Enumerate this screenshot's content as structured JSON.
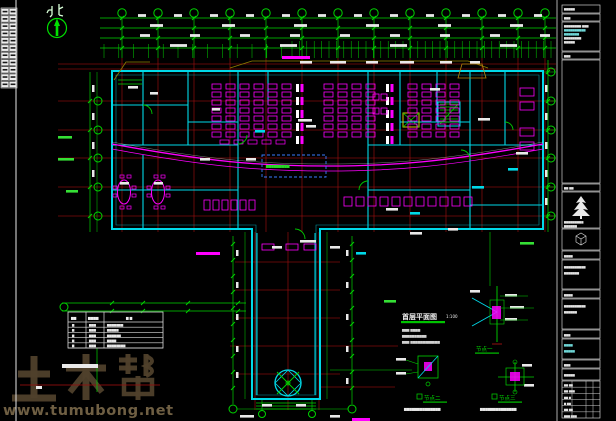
{
  "colors": {
    "green": "#00d400",
    "brightgreen": "#35e035",
    "cyan": "#00d9e8",
    "magenta": "#ff00ff",
    "red": "#8f0f0f",
    "yellow": "#d8c300",
    "olive": "#8f7f00",
    "white": "#e9e9e9",
    "blue": "#3a7bff",
    "watermark_brand": "#4f402b",
    "watermark_url": "#6f5f43"
  },
  "compass": {
    "label": "北"
  },
  "watermark": {
    "brand": "土木帮",
    "url": "www.tumubong.net"
  },
  "plan": {
    "title": "首层平面图",
    "scale": "1:100",
    "notes": [
      "▆▆▆ ▆▆▆▆",
      "▆▆▆▆▆▆▆▆▆▆",
      "▆▆▆ ▆▆▆▆▆▆▆▆▆▆▆▆"
    ],
    "center_note": "▆▆▆▆▆▆▆▆▆"
  },
  "details": {
    "d1": "节点一",
    "d2": "节点二",
    "d3": "节点三",
    "caption2": "▆▆▆▆▆▆▆▆▆▆▆▆▆▆",
    "caption3": "▆▆▆▆▆▆▆▆▆▆▆▆▆▆"
  },
  "legend": {
    "headers": [
      "▆▆",
      "▆▆▆▆",
      "▆ ▆"
    ],
    "rows": [
      [
        "▆",
        "▆▆▆",
        "▆▆▆▆▆▆▆"
      ],
      [
        "▆",
        "▆▆▆",
        "▆▆▆▆▆"
      ],
      [
        "▆",
        "▆▆▆",
        "▆▆▆▆▆▆"
      ],
      [
        "▆",
        "▆▆▆",
        "▆▆▆▆"
      ],
      [
        "▆",
        "▆▆▆",
        "▆▆▆▆▆▆▆▆"
      ]
    ]
  },
  "titleblock": {
    "top_lines": [
      "▆▆▆▆▆",
      "▆▆▆",
      "▆▆▆▆▆▆▆▆ ▆▆▆",
      "▆▆▆▆▆▆▆▆▆▆",
      "▆▆▆▆▆▆▆",
      "▆▆▆▆▆▆▆▆",
      "▆▆▆▆▆",
      "▆▆▆"
    ],
    "mid_labels": [
      "▆▆ ▆▆",
      "▆▆▆▆▆▆▆▆▆",
      "▆▆▆▆▆▆",
      "▆▆▆▆",
      "▆▆▆▆▆▆▆▆▆▆",
      "▆▆▆▆▆▆▆",
      "▆▆▆▆",
      "▆▆▆▆▆▆▆▆▆▆",
      "▆▆▆▆▆▆",
      "▆▆▆",
      "▆▆▆▆",
      "▆▆▆▆▆",
      "▆▆▆",
      "▆▆▆▆▆"
    ],
    "bottom_rows": [
      "▆▆ ▆▆",
      "▆▆ ▆▆▆",
      "▆▆ ▆",
      "▆ ▆▆",
      "▆▆ ▆▆",
      "▆▆▆ ▆▆▆"
    ]
  }
}
